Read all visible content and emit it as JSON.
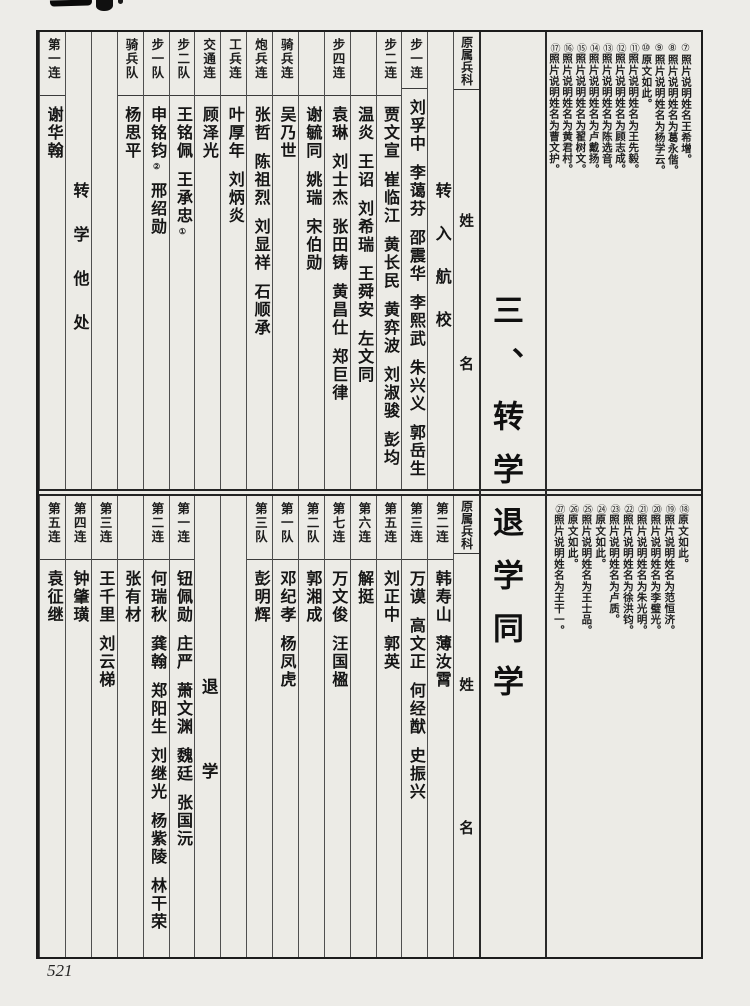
{
  "page": {
    "number": "521",
    "section_title": "三、转学退学同学"
  },
  "top_table": {
    "columns": [
      {
        "type": "head",
        "branch": "原属兵科",
        "surname": "姓",
        "given": "名"
      },
      {
        "type": "label",
        "text": "转入航校"
      },
      {
        "type": "unit",
        "unit": "步一连",
        "names": [
          "刘孚中",
          "李蔼芬",
          "邵震华",
          "李熙武",
          "朱兴义",
          "郭岳生"
        ]
      },
      {
        "type": "unit",
        "unit": "步二连",
        "names": [
          "贾文宣",
          "崔临江",
          "黄长民",
          "黄弈波",
          "刘淑骏",
          "彭均"
        ]
      },
      {
        "type": "cont",
        "unit": "",
        "names": [
          "温炎",
          "王诏",
          "刘希瑞",
          "王舜安",
          "左文同"
        ]
      },
      {
        "type": "unit",
        "unit": "步四连",
        "names": [
          "袁琳",
          "刘士杰",
          "张田铸",
          "黄昌仕",
          "郑巨律"
        ]
      },
      {
        "type": "cont",
        "unit": "",
        "names": [
          "谢毓同",
          "姚瑞",
          "宋伯勋"
        ]
      },
      {
        "type": "unit",
        "unit": "骑兵连",
        "names": [
          "吴乃世"
        ]
      },
      {
        "type": "unit",
        "unit": "炮兵连",
        "names": [
          "张哲",
          "陈祖烈",
          "刘显祥",
          "石顺承"
        ]
      },
      {
        "type": "unit",
        "unit": "工兵连",
        "names": [
          "叶厚年",
          "刘炳炎"
        ]
      },
      {
        "type": "unit",
        "unit": "交通连",
        "names": [
          "顾泽光"
        ]
      },
      {
        "type": "unit",
        "unit": "步二队",
        "names": [
          "王铭佩",
          {
            "name": "王承忠",
            "marker": "①"
          }
        ]
      },
      {
        "type": "unit",
        "unit": "步一队",
        "names": [
          {
            "name": "申铭钧",
            "marker": "②"
          },
          "邢绍勋"
        ]
      },
      {
        "type": "unit",
        "unit": "骑兵队",
        "names": [
          "杨思平"
        ]
      },
      {
        "type": "empty"
      },
      {
        "type": "label",
        "text": "转学他处"
      },
      {
        "type": "unit",
        "unit": "第一连",
        "names": [
          "谢华翰"
        ]
      }
    ]
  },
  "bottom_table": {
    "columns": [
      {
        "type": "head",
        "branch": "原属兵科",
        "surname": "姓",
        "given": "名"
      },
      {
        "type": "unit",
        "unit": "第二连",
        "names": [
          "韩寿山",
          "薄汝霄"
        ]
      },
      {
        "type": "unit",
        "unit": "第三连",
        "names": [
          "万谟",
          "高文正",
          "何经猷",
          "史振兴"
        ]
      },
      {
        "type": "unit",
        "unit": "第五连",
        "names": [
          "刘正中",
          "郭英"
        ]
      },
      {
        "type": "unit",
        "unit": "第六连",
        "names": [
          "解挺"
        ]
      },
      {
        "type": "unit",
        "unit": "第七连",
        "names": [
          "万文俊",
          "汪国楹"
        ]
      },
      {
        "type": "unit",
        "unit": "第二队",
        "names": [
          "郭湘成"
        ]
      },
      {
        "type": "unit",
        "unit": "第一队",
        "names": [
          "邓纪孝",
          "杨凤虎"
        ]
      },
      {
        "type": "unit",
        "unit": "第三队",
        "names": [
          "彭明辉"
        ]
      },
      {
        "type": "empty"
      },
      {
        "type": "label",
        "text": "退学"
      },
      {
        "type": "unit",
        "unit": "第一连",
        "names": [
          "钮佩勋",
          "庄严",
          "萧文渊",
          "魏廷",
          "张国沅"
        ]
      },
      {
        "type": "unit",
        "unit": "第二连",
        "names": [
          "何瑞秋",
          "龚翰",
          "郑阳生",
          "刘继光",
          "杨紫陵",
          "林干荣"
        ]
      },
      {
        "type": "cont",
        "unit": "",
        "names": [
          "张有材"
        ]
      },
      {
        "type": "unit",
        "unit": "第三连",
        "names": [
          "王千里",
          "刘云梯"
        ]
      },
      {
        "type": "unit",
        "unit": "第四连",
        "names": [
          "钟肇璜"
        ]
      },
      {
        "type": "unit",
        "unit": "第五连",
        "names": [
          "袁征继"
        ]
      }
    ]
  },
  "annotations_top": [
    {
      "num": "⑦",
      "text": "照片说明姓名王希增。"
    },
    {
      "num": "⑧",
      "text": "照片说明姓名为葛永偕。"
    },
    {
      "num": "⑨",
      "text": "照片说明姓名为杨学云。"
    },
    {
      "num": "⑩",
      "text": "原文如此。"
    },
    {
      "num": "⑪",
      "text": "照片说明姓名为王先毅。"
    },
    {
      "num": "⑫",
      "text": "照片说明姓名为顾志成。"
    },
    {
      "num": "⑬",
      "text": "照片说明姓名为陈选音。"
    },
    {
      "num": "⑭",
      "text": "照片说明姓名为卢戴扬。"
    },
    {
      "num": "⑮",
      "text": "照片说明姓名为翟树文。"
    },
    {
      "num": "⑯",
      "text": "照片说明姓名为黄君村。"
    },
    {
      "num": "⑰",
      "text": "照片说明姓名为曹文护。"
    }
  ],
  "annotations_bottom": [
    {
      "num": "⑱",
      "text": "原文如此。"
    },
    {
      "num": "⑲",
      "text": "照片说明姓名为范恒济。"
    },
    {
      "num": "⑳",
      "text": "照片说明姓名为李璧光。"
    },
    {
      "num": "㉑",
      "text": "照片说明姓名为朱光明。"
    },
    {
      "num": "㉒",
      "text": "照片说明姓名为徐洪钧。"
    },
    {
      "num": "㉓",
      "text": "照片说明姓名为卢质。"
    },
    {
      "num": "㉔",
      "text": "原文如此。"
    },
    {
      "num": "㉕",
      "text": "照片说明姓名为王士品。"
    },
    {
      "num": "㉖",
      "text": "原文如此。"
    },
    {
      "num": "㉗",
      "text": "照片说明姓名为王干一。"
    }
  ]
}
